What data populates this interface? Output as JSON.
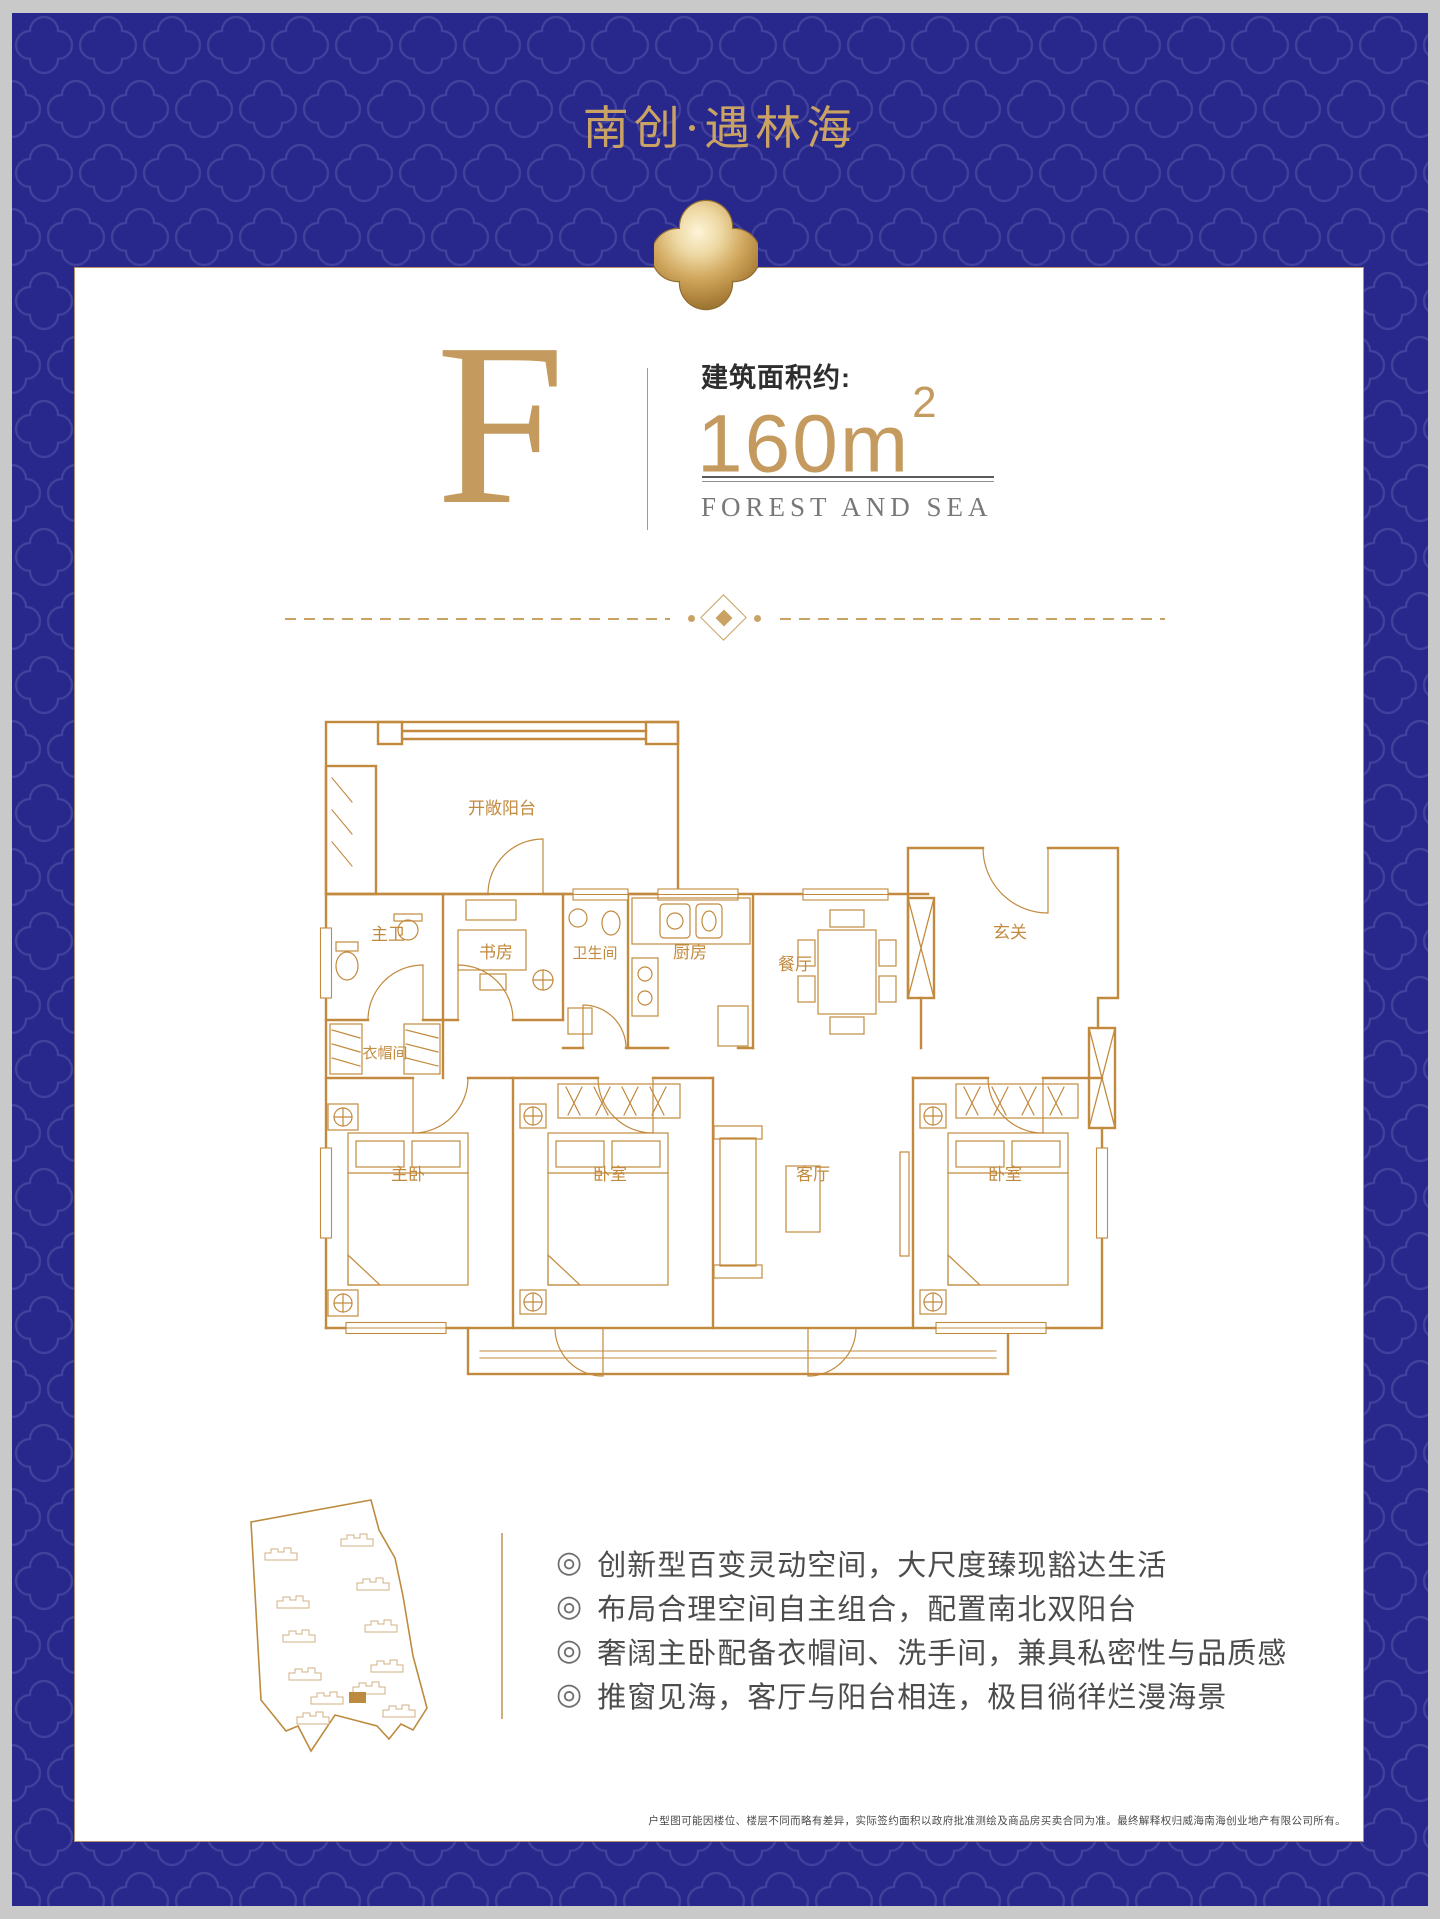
{
  "header": {
    "title": "南创·遇林海"
  },
  "unit": {
    "letter": "F",
    "area_label": "建筑面积约:",
    "area_value": "160m",
    "area_sup": "2",
    "subtitle": "FOREST AND SEA"
  },
  "floorplan": {
    "rooms": [
      "开敞阳台",
      "主卫",
      "书房",
      "卫生间",
      "厨房",
      "餐厅",
      "玄关",
      "衣帽间",
      "主卧",
      "卧室",
      "客厅",
      "卧室"
    ]
  },
  "features": {
    "marker": "◎",
    "items": [
      "创新型百变灵动空间，大尺度臻现豁达生活",
      "布局合理空间自主组合，配置南北双阳台",
      "奢阔主卧配备衣帽间、洗手间，兼具私密性与品质感",
      "推窗见海，客厅与阳台相连，极目徜徉烂漫海景"
    ]
  },
  "disclaimer": "户型图可能因楼位、楼层不同而略有差异，实际签约面积以政府批准测绘及商品房买卖合同为准。最终解释权归威海南海创业地产有限公司所有。",
  "colors": {
    "frame_blue": "#28288c",
    "pattern_line": "#42429c",
    "gold": "#c9a264",
    "plan_line": "#c28a3e",
    "text_dark": "#2e2e2e",
    "text_gray": "#787878"
  }
}
